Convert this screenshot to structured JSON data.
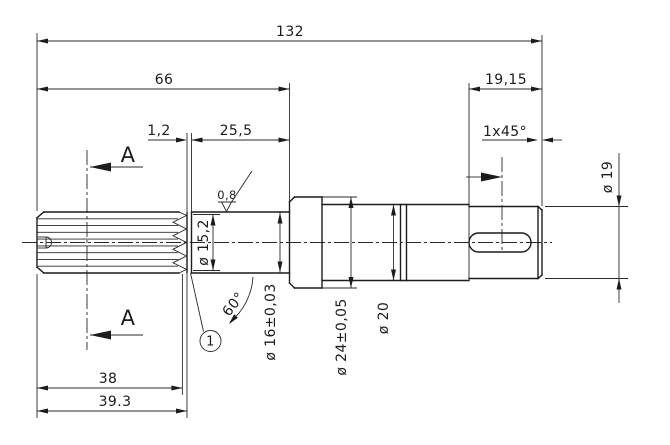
{
  "drawing": {
    "dims": {
      "total_length": "132",
      "left_section_length": "66",
      "end_section_length": "19,15",
      "relief_groove_width": "1,2",
      "shoulder_length": "25,5",
      "end_chamfer": "1x45°",
      "spline_length": "38",
      "spline_overall_length": "39.3",
      "relief_groove_diameter": "ø 15,2",
      "shoulder_diameter": "ø 16±0,03",
      "collar_diameter": "ø 24±0,05",
      "middle_diameter": "ø 20",
      "end_diameter": "ø 19",
      "relief_groove_angle": "60°",
      "surface_roughness": "0,8",
      "detail_balloon": "1"
    },
    "section": {
      "label_top": "A",
      "label_bottom": "A"
    }
  }
}
